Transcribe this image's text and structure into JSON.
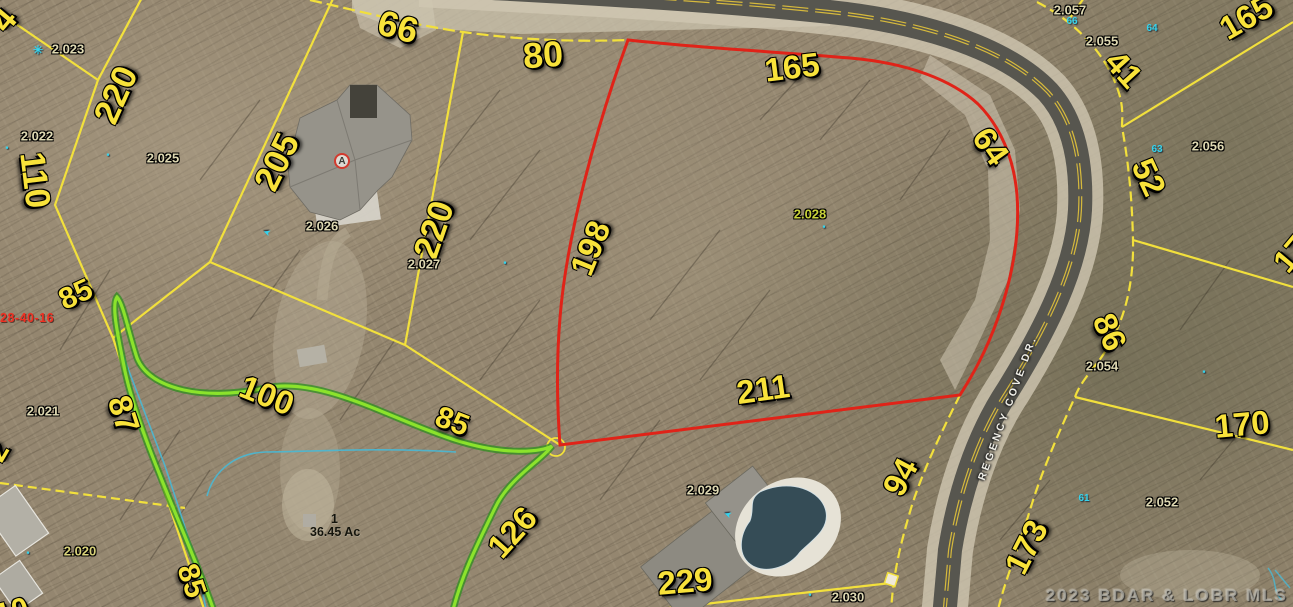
{
  "map": {
    "type": "aerial-parcel-map",
    "road_name": "REGENCY COVE DR.",
    "watermark": "2023 BDAR & LOBR MLS",
    "section_id": "28-40-16",
    "tract": {
      "lot": "1",
      "area": "36.45 Ac"
    },
    "highlighted_parcel": {
      "id": "2.028",
      "boundary_color": "#e02318",
      "dimensions": [
        "165",
        "64",
        "211",
        "198"
      ]
    },
    "colors": {
      "parcel_line": "#f2e03c",
      "highlight_line": "#e02318",
      "stream_line": "#7fe02c",
      "water_line": "#49b8d4",
      "dimension_text": "#f8e23a",
      "parcel_id_text": "#ded8b2",
      "lot_number_text": "#35d4ee",
      "road_asphalt": "#57564f",
      "road_shoulder": "#cfc7b2"
    },
    "dimension_labels": [
      {
        "text": "66",
        "x": 398,
        "y": 27,
        "rot": 15,
        "size": 36
      },
      {
        "text": "80",
        "x": 543,
        "y": 55,
        "rot": -4,
        "size": 36
      },
      {
        "text": "165",
        "x": 792,
        "y": 67,
        "rot": -7,
        "size": 33
      },
      {
        "text": "64",
        "x": 991,
        "y": 146,
        "rot": 55,
        "size": 33
      },
      {
        "text": "41",
        "x": 1124,
        "y": 69,
        "rot": 48,
        "size": 33
      },
      {
        "text": "52",
        "x": 1149,
        "y": 177,
        "rot": 65,
        "size": 33
      },
      {
        "text": "165",
        "x": 1246,
        "y": 17,
        "rot": -30,
        "size": 33
      },
      {
        "text": "86",
        "x": 1110,
        "y": 332,
        "rot": 66,
        "size": 33
      },
      {
        "text": "170",
        "x": 1242,
        "y": 424,
        "rot": -5,
        "size": 33
      },
      {
        "text": "173",
        "x": 1026,
        "y": 547,
        "rot": -63,
        "size": 33
      },
      {
        "text": "94",
        "x": 900,
        "y": 477,
        "rot": -62,
        "size": 33
      },
      {
        "text": "211",
        "x": 763,
        "y": 389,
        "rot": -8,
        "size": 33
      },
      {
        "text": "229",
        "x": 685,
        "y": 581,
        "rot": -5,
        "size": 33
      },
      {
        "text": "126",
        "x": 512,
        "y": 532,
        "rot": -48,
        "size": 33
      },
      {
        "text": "85",
        "x": 452,
        "y": 422,
        "rot": 21,
        "size": 30
      },
      {
        "text": "198",
        "x": 590,
        "y": 248,
        "rot": -68,
        "size": 33
      },
      {
        "text": "220",
        "x": 434,
        "y": 230,
        "rot": -71,
        "size": 35
      },
      {
        "text": "205",
        "x": 277,
        "y": 162,
        "rot": -64,
        "size": 35
      },
      {
        "text": "220",
        "x": 116,
        "y": 95,
        "rot": -66,
        "size": 35
      },
      {
        "text": "110",
        "x": 35,
        "y": 180,
        "rot": 83,
        "size": 35
      },
      {
        "text": "85",
        "x": 76,
        "y": 295,
        "rot": -25,
        "size": 30
      },
      {
        "text": "100",
        "x": 267,
        "y": 395,
        "rot": 22,
        "size": 33
      },
      {
        "text": "87",
        "x": 124,
        "y": 414,
        "rot": 72,
        "size": 33
      },
      {
        "text": "85",
        "x": 191,
        "y": 581,
        "rot": 71,
        "size": 30
      }
    ],
    "partial_labels": [
      {
        "text": "4",
        "x": 4,
        "y": 20,
        "rot": -50,
        "size": 34
      },
      {
        "text": "17",
        "x": 1291,
        "y": 254,
        "rot": -50,
        "size": 32
      },
      {
        "text": "2",
        "x": -2,
        "y": 452,
        "rot": -60,
        "size": 30
      },
      {
        "text": "10",
        "x": 12,
        "y": 612,
        "rot": -15,
        "size": 30
      }
    ],
    "parcel_ids": [
      {
        "text": "2.023",
        "x": 68,
        "y": 49
      },
      {
        "text": "2.022",
        "x": 37,
        "y": 136
      },
      {
        "text": "2.025",
        "x": 163,
        "y": 158
      },
      {
        "text": "2.026",
        "x": 322,
        "y": 226
      },
      {
        "text": "2.027",
        "x": 424,
        "y": 264
      },
      {
        "text": "2.028",
        "x": 810,
        "y": 214,
        "color": "#c8d23a"
      },
      {
        "text": "2.029",
        "x": 703,
        "y": 490
      },
      {
        "text": "2.030",
        "x": 848,
        "y": 597
      },
      {
        "text": "2.021",
        "x": 43,
        "y": 411
      },
      {
        "text": "2.020",
        "x": 80,
        "y": 551,
        "color": "#d8d27a"
      },
      {
        "text": "2.057",
        "x": 1070,
        "y": 10
      },
      {
        "text": "2.055",
        "x": 1102,
        "y": 41
      },
      {
        "text": "2.056",
        "x": 1208,
        "y": 146
      },
      {
        "text": "2.054",
        "x": 1102,
        "y": 366
      },
      {
        "text": "2.052",
        "x": 1162,
        "y": 502
      }
    ],
    "lot_numbers": [
      {
        "text": "66",
        "x": 1072,
        "y": 22
      },
      {
        "text": "64",
        "x": 1152,
        "y": 29
      },
      {
        "text": "63",
        "x": 1157,
        "y": 150
      },
      {
        "text": "61",
        "x": 1084,
        "y": 499
      }
    ],
    "marker_icons": [
      {
        "type": "tree",
        "x": 38,
        "y": 50
      },
      {
        "type": "dot",
        "x": 7,
        "y": 148
      },
      {
        "type": "dot",
        "x": 108,
        "y": 155
      },
      {
        "type": "arrow",
        "x": 267,
        "y": 232
      },
      {
        "type": "dot",
        "x": 505,
        "y": 263
      },
      {
        "type": "dot",
        "x": 824,
        "y": 227
      },
      {
        "type": "arrow",
        "x": 728,
        "y": 514
      },
      {
        "type": "dot",
        "x": 810,
        "y": 595
      },
      {
        "type": "dot",
        "x": 1204,
        "y": 372
      },
      {
        "type": "dot",
        "x": 28,
        "y": 553
      }
    ],
    "house_marker": {
      "letter": "A",
      "x": 342,
      "y": 161
    }
  }
}
